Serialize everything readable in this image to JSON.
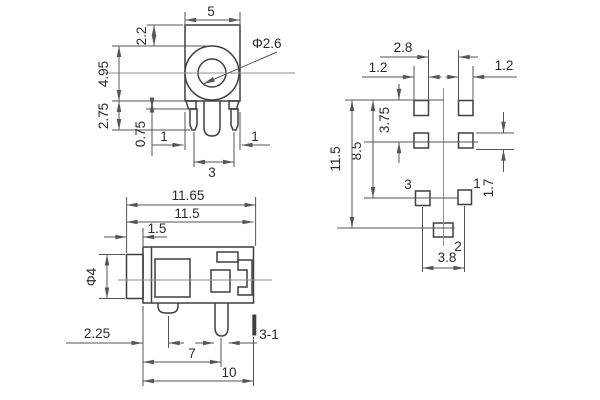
{
  "drawing": {
    "front_view": {
      "width": "5",
      "hole_dia": "Φ2.6",
      "top_to_ring": "2.2",
      "ring_dia": "4.95",
      "pin_length": "2.75",
      "tab_height": "0.75",
      "left_pin_offset": "1",
      "pin_spacing": "3",
      "right_pin_offset": "1"
    },
    "side_view": {
      "overall_length": "11.65",
      "body_with_barrel": "11.5",
      "barrel_length": "1.5",
      "barrel_dia": "Φ4",
      "pin1_offset": "2.25",
      "pin2_offset": "7",
      "body_length": "10",
      "pin_note": "3-1"
    },
    "footprint": {
      "pad_col_gap": "2.8",
      "pad_width_left": "1.2",
      "pad_width_right": "1.2",
      "row_pitch": "3.75",
      "mid_height": "8.5",
      "total_height": "11.5",
      "pad_height": "1.7",
      "bottom_pitch": "3.8",
      "pin1_label": "1",
      "pin2_label": "2",
      "pin3_label": "3"
    }
  },
  "colors": {
    "outline": "#3f3f3f",
    "dimension": "#565656",
    "centerline": "#8f8f8f",
    "background": "#ffffff",
    "text": "#2a2a2a"
  }
}
